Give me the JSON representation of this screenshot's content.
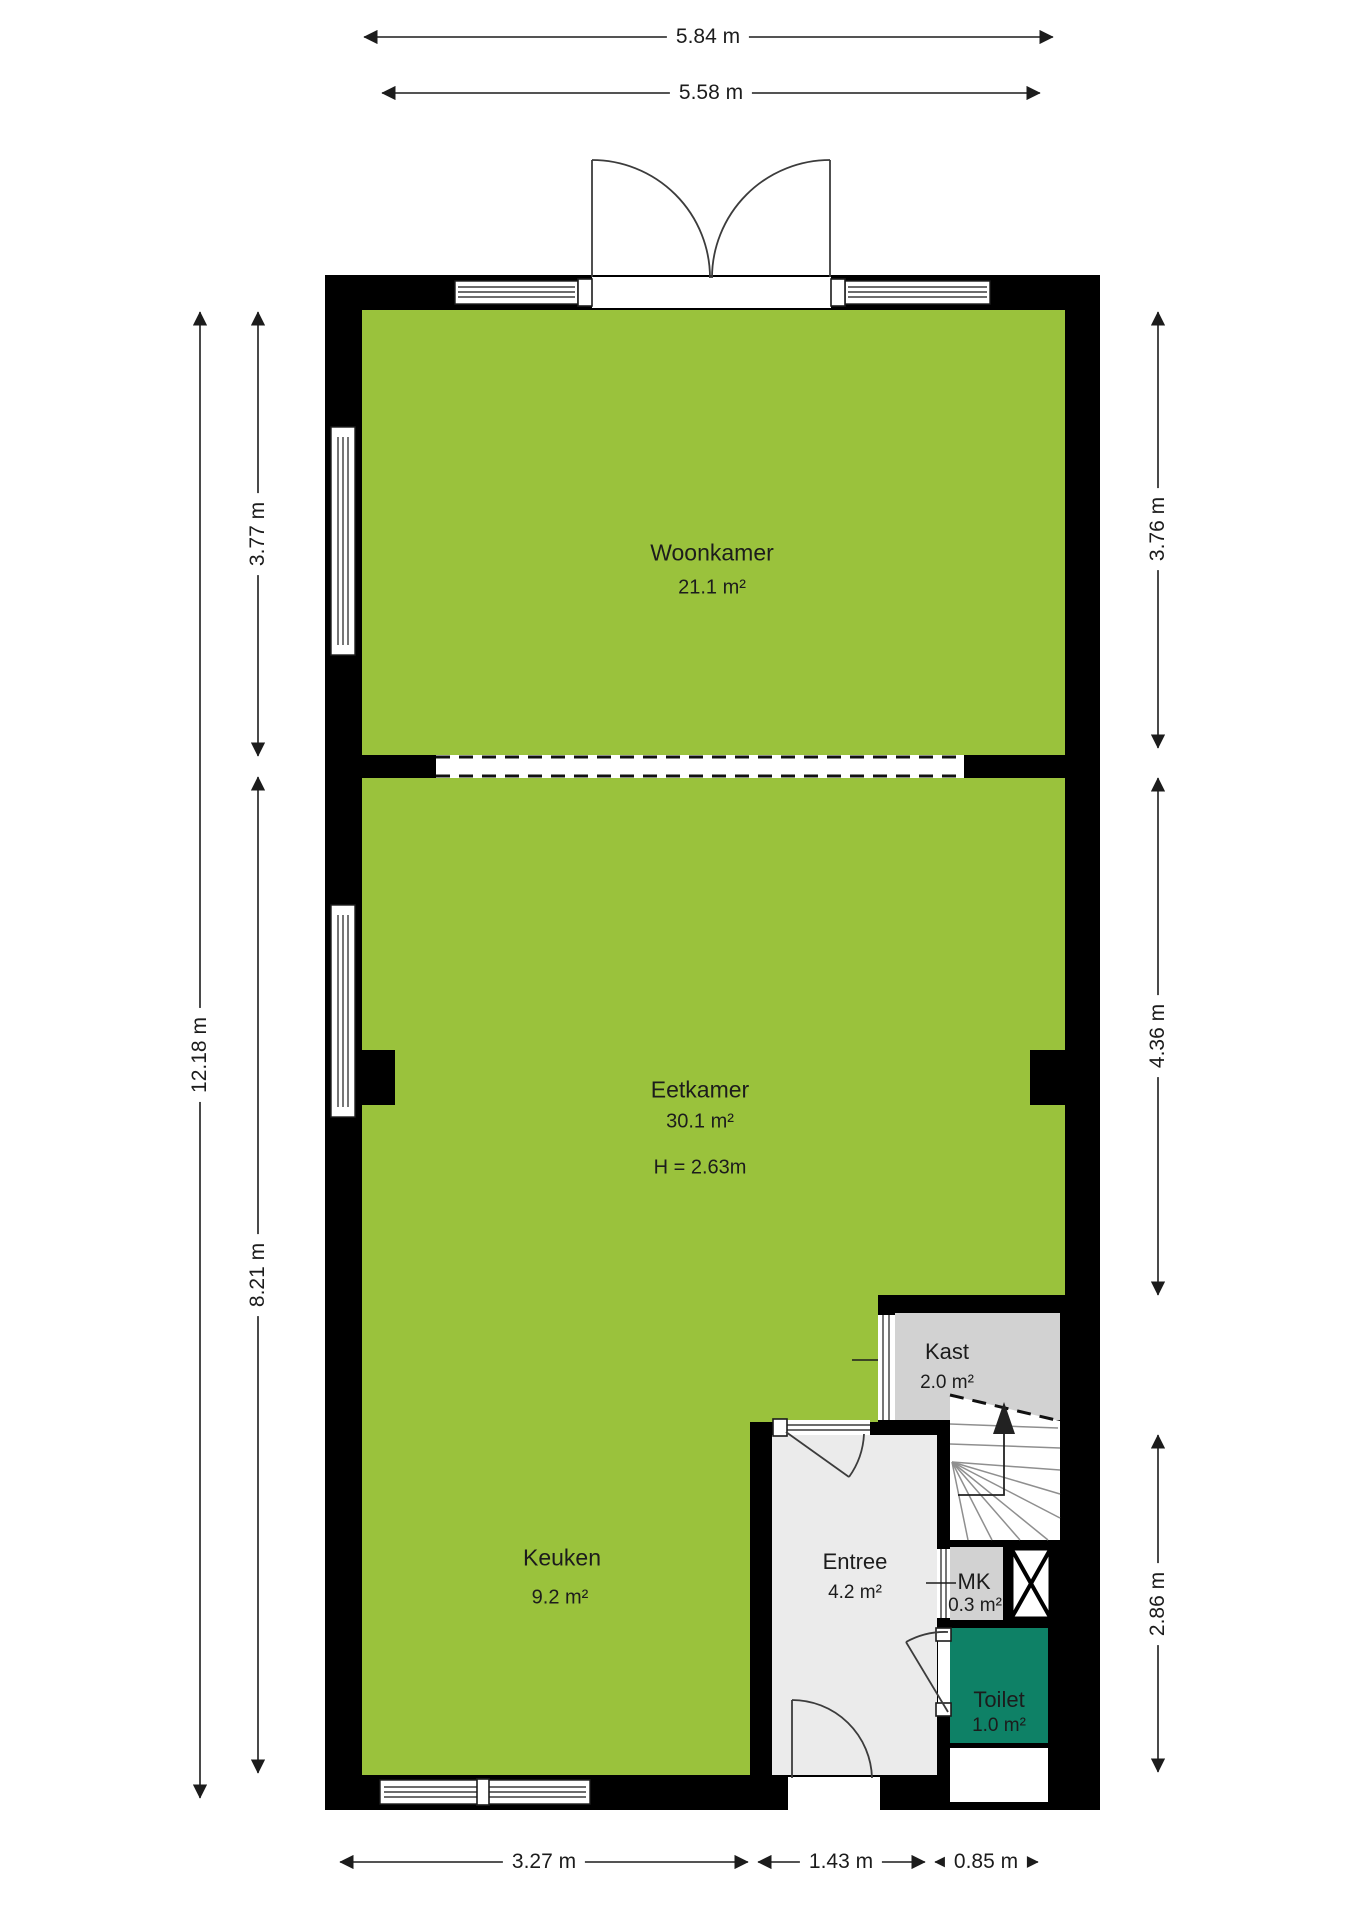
{
  "plan": {
    "rooms": {
      "woonkamer": {
        "name": "Woonkamer",
        "area": "21.1 m²"
      },
      "eetkamer": {
        "name": "Eetkamer",
        "area": "30.1 m²",
        "ceiling_height": "H = 2.63m"
      },
      "keuken": {
        "name": "Keuken",
        "area": "9.2 m²"
      },
      "kast": {
        "name": "Kast",
        "area": "2.0 m²"
      },
      "entree": {
        "name": "Entree",
        "area": "4.2 m²"
      },
      "mk": {
        "name": "MK",
        "area": "0.3 m²"
      },
      "toilet": {
        "name": "Toilet",
        "area": "1.0 m²"
      }
    },
    "dimensions": {
      "top_outer": "5.84 m",
      "top_inner": "5.58 m",
      "left_total": "12.18 m",
      "left_upper": "3.77 m",
      "left_lower": "8.21 m",
      "right_upper": "3.76 m",
      "right_middle": "4.36 m",
      "right_lower": "2.86 m",
      "bottom_left": "3.27 m",
      "bottom_middle": "1.43 m",
      "bottom_right": "0.85 m"
    },
    "colors": {
      "room_fill": "#9ac23c",
      "toilet_fill": "#0e8166",
      "closet_fill": "#d2d2d2",
      "hall_fill": "#ebebeb",
      "wall": "#000000"
    }
  }
}
